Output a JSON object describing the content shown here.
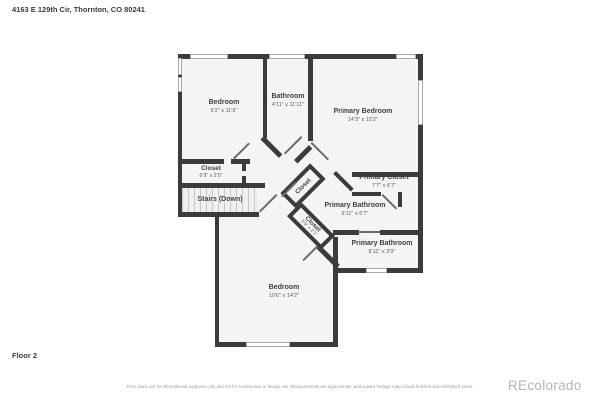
{
  "header": {
    "address": "4163 E 129th Cir, Thornton, CO 80241"
  },
  "footer": {
    "floor_label": "Floor 2",
    "disclaimer": "Floor plans are for informational purposes only and not for construction or design use. Measurements are approximate, and square footage may include finished and unfinished areas.",
    "watermark": "REcolorado"
  },
  "colors": {
    "wall": "#3b3b3b",
    "room_fill": "#f4f4f3",
    "background": "#ffffff",
    "label_text": "#404040",
    "dims_text": "#5c5c5c",
    "watermark_text": "#b5b5b5"
  },
  "rooms": {
    "bedroom1": {
      "name": "Bedroom",
      "dims": "9'2\" x 11'9\""
    },
    "bathroom": {
      "name": "Bathroom",
      "dims": "4'11\" x 11'11\""
    },
    "primary_bedroom": {
      "name": "Primary Bedroom",
      "dims": "14'3\" x 15'2\""
    },
    "closet_left": {
      "name": "Closet",
      "dims": "6'9\" x 2'0\""
    },
    "stairs": {
      "name": "Stairs (Down)"
    },
    "primary_closet": {
      "name": "Primary Closet",
      "dims": "7'7\" x 6'7\""
    },
    "primary_bathroom1": {
      "name": "Primary Bathroom",
      "dims": "9'11\" x 6'7\""
    },
    "hall_closet1": {
      "name": "Closet"
    },
    "hall_closet2": {
      "name": "Closet",
      "dims": "5'9\" x 2'1\""
    },
    "primary_bathroom2": {
      "name": "Primary Bathroom",
      "dims": "8'11\" x 3'9\""
    },
    "bedroom2": {
      "name": "Bedroom",
      "dims": "10'6\" x 14'2\""
    }
  }
}
